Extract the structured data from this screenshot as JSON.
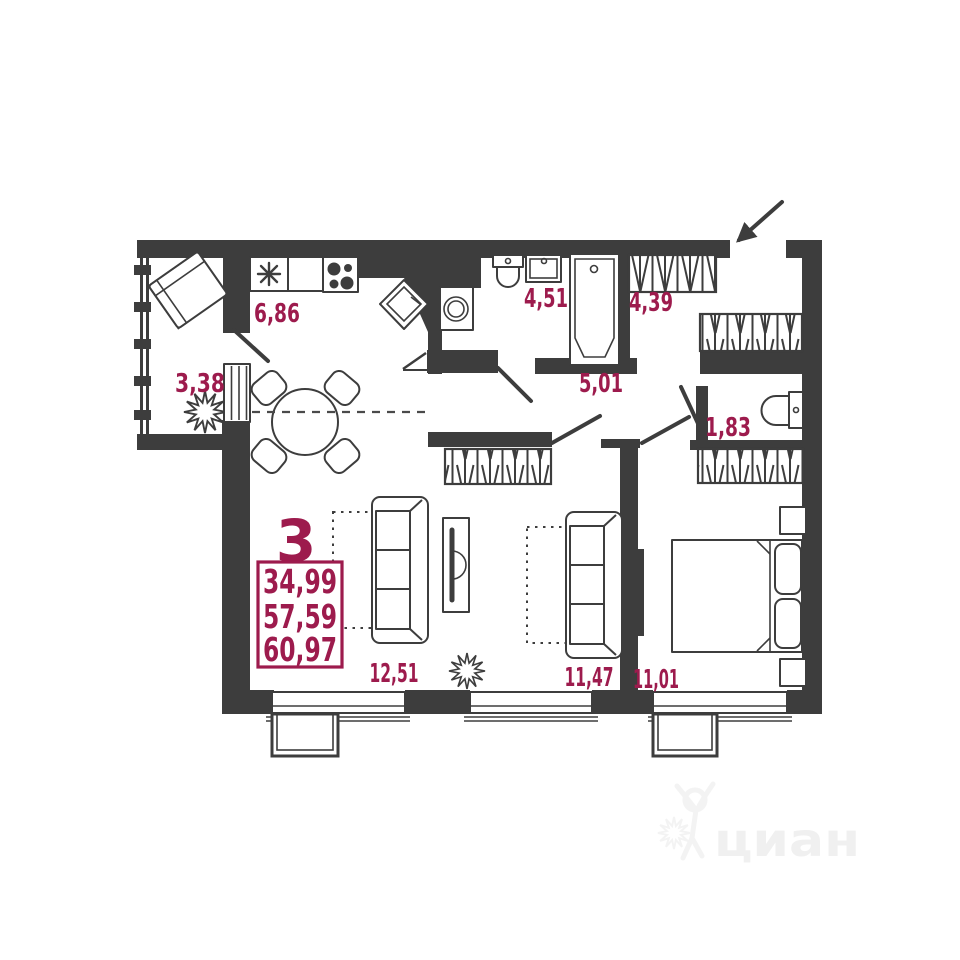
{
  "plan_type": "apartment-floor-plan",
  "summary": {
    "rooms_count": "3",
    "living_area": "34,99",
    "floor_area": "57,59",
    "total_area": "60,97"
  },
  "rooms": {
    "kitchen": "6,86",
    "balcony": "3,38",
    "bathroom": "4,51",
    "hall": "4,39",
    "corridor": "5,01",
    "wc": "1,83",
    "living": "12,51",
    "bedroom1": "11,47",
    "bedroom2": "11,01"
  },
  "watermark": {
    "text": "циан"
  },
  "colors": {
    "wall": "#3d3d3d",
    "accent": "#9d1b4d",
    "watermark": "#f0f0f0",
    "background": "#ffffff"
  },
  "icons": {
    "sink-icon": "six-ray asterisk",
    "stove-icon": "four burner circles",
    "corner-cabinet-icon": "rotated square",
    "washing-machine-icon": "square with drum circle",
    "toilet-icon": "tank and bowl",
    "bathtub-icon": "tub outline with drain",
    "wardrobe-icon": "hatched rectangle",
    "sofa-icon": "three-seat sofa outline",
    "bed-icon": "double bed with pillows and nightstands",
    "dining-table-icon": "round table with four chairs",
    "armchair-icon": "rotated armchair",
    "plant-icon": "spiky plant star",
    "entrance-arrow-icon": "diagonal arrow at entry door",
    "watermark-logo-icon": "dancing figure"
  }
}
